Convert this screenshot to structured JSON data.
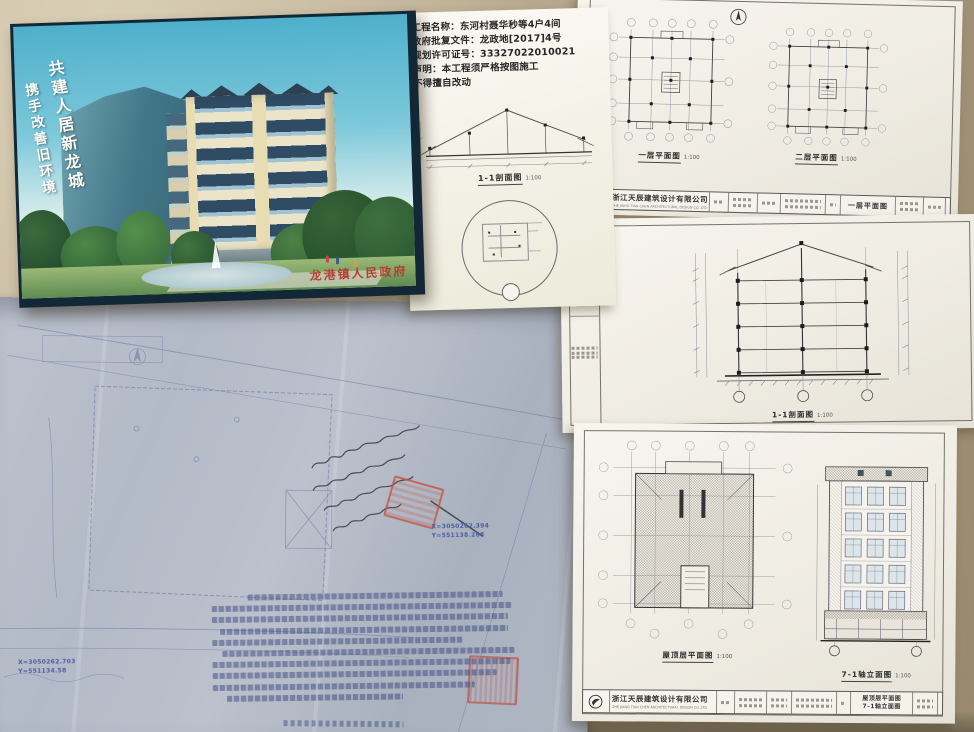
{
  "poster": {
    "slogan_right": "共建人居新龙城",
    "slogan_left": "携手改善旧环境",
    "government_stamp": "龙港镇人民政府"
  },
  "permit_sheet": {
    "line1": "工程名称：东河村聂华秒等4户4间",
    "line2": "政府批复文件：龙政地[2017]4号",
    "line3": "规划许可证号：33327022010021",
    "line4": "声明：本工程须严格按图施工",
    "line5": "不得擅自改动",
    "section_label": "1-1剖面图",
    "section_scale": "1:100"
  },
  "plans_sheet": {
    "plan1_label": "一层平面图",
    "plan1_scale": "1:100",
    "plan2_label": "二层平面图",
    "plan2_scale": "1:100",
    "titleblock": {
      "company_cn": "浙江天辰建筑设计有限公司",
      "company_en": "ZHE JIANG TIAN CHEN ARCHITECTURAL DESIGN CO.,LTD",
      "drawing_name": "一层平面图"
    }
  },
  "section_sheet": {
    "label": "1-1剖面图",
    "scale": "1:100"
  },
  "roof_elev_sheet": {
    "roof_label": "屋顶层平面图",
    "roof_scale": "1:100",
    "elev_label": "7-1轴立面图",
    "elev_scale": "1:100",
    "titleblock": {
      "company_cn": "浙江天辰建筑设计有限公司",
      "company_en": "ZHE JIANG TIAN CHEN ARCHITECTURAL DESIGN CO.,LTD",
      "drawing_name1": "屋顶层平面图",
      "drawing_name2": "7-1轴立面图"
    }
  },
  "blueprint": {
    "coord_a_x": "X=3050262.394",
    "coord_a_y": "Y=551138.288",
    "coord_b_x": "X=3050262.703",
    "coord_b_y": "Y=551134.58"
  },
  "colors": {
    "wall": "#b3a489",
    "paper": "#f4f1ea",
    "blueprint_paper": "#b2b8c5",
    "stamp_red": "#c0504a",
    "ink_blue": "#5a6aa0",
    "sky_blue": "#4fb0cc"
  }
}
